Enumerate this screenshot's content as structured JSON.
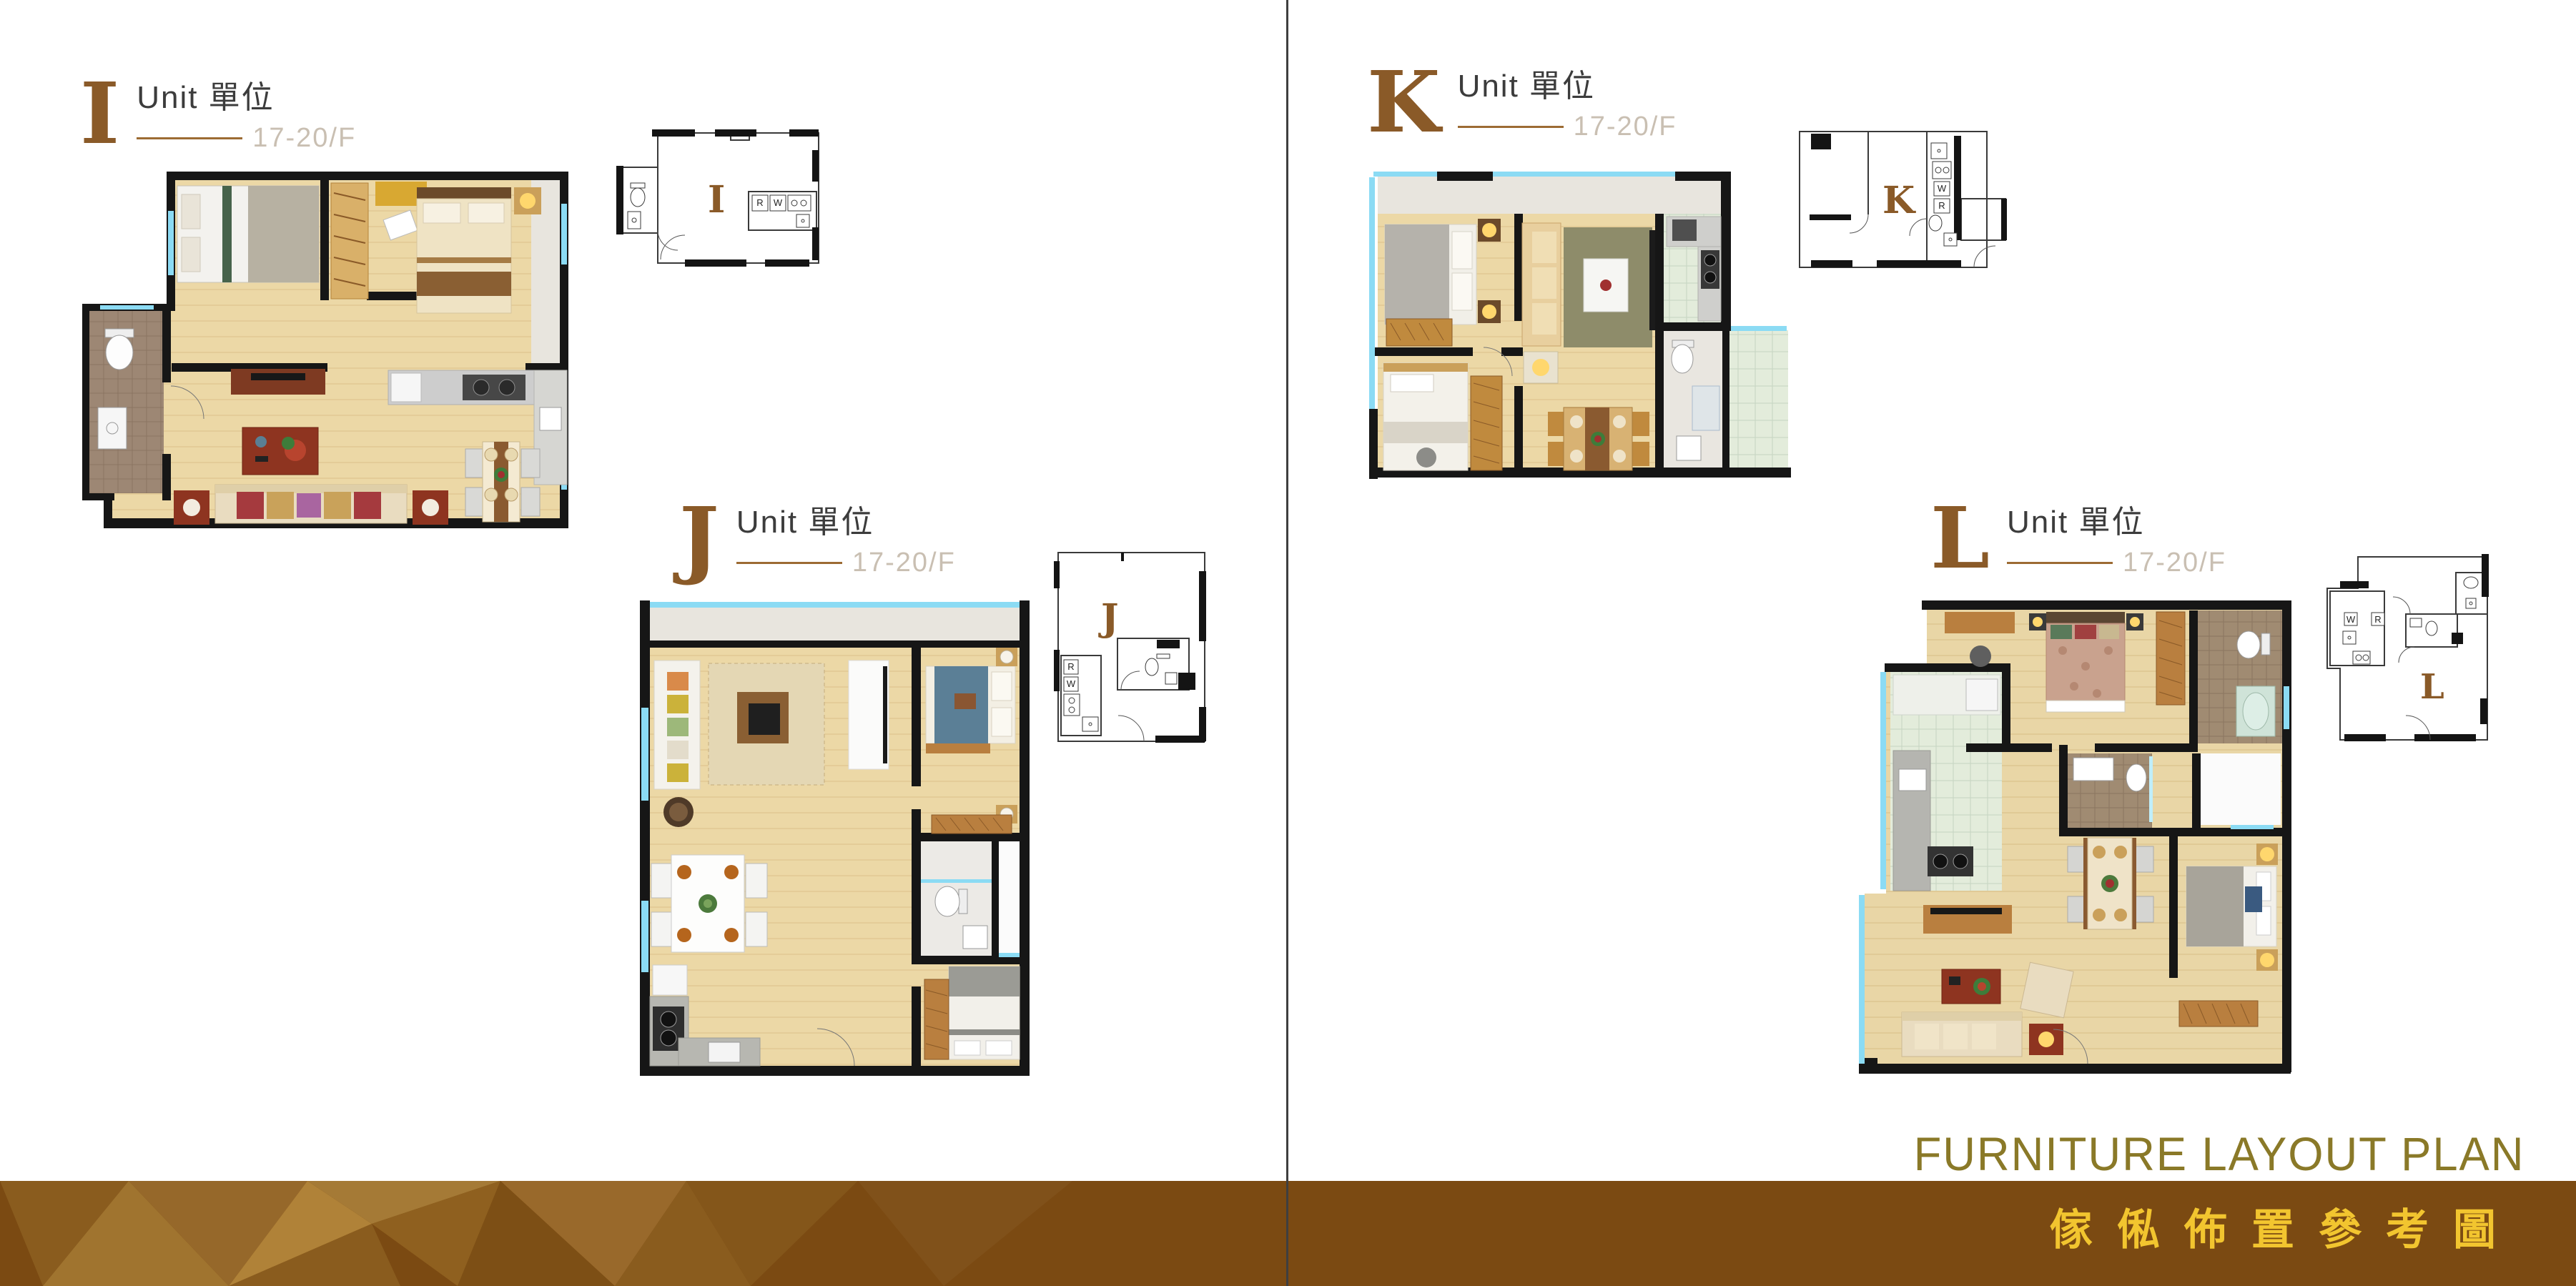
{
  "units": [
    {
      "id": "I",
      "unit_label": "Unit 單位",
      "floor": "17-20/F"
    },
    {
      "id": "J",
      "unit_label": "Unit 單位",
      "floor": "17-20/F"
    },
    {
      "id": "K",
      "unit_label": "Unit 單位",
      "floor": "17-20/F"
    },
    {
      "id": "L",
      "unit_label": "Unit 單位",
      "floor": "17-20/F"
    }
  ],
  "schematic_labels": {
    "fridge": "R",
    "washer": "W"
  },
  "footer": {
    "title_en": "FURNITURE LAYOUT PLAN",
    "title_zh": "傢俬佈置參考圖"
  },
  "colors": {
    "unit_letter": "#8a5a28",
    "unit_label_text": "#3c3c3c",
    "floor_text": "#c9bfb2",
    "accent_rule": "#9c6b33",
    "title_en": "#8a7928",
    "title_zh": "#f2c52f",
    "band_brown": "#7b4a12",
    "wall_black": "#161616",
    "window_cyan": "#8bdbf4",
    "wood_floor": "#ecd8a6"
  }
}
